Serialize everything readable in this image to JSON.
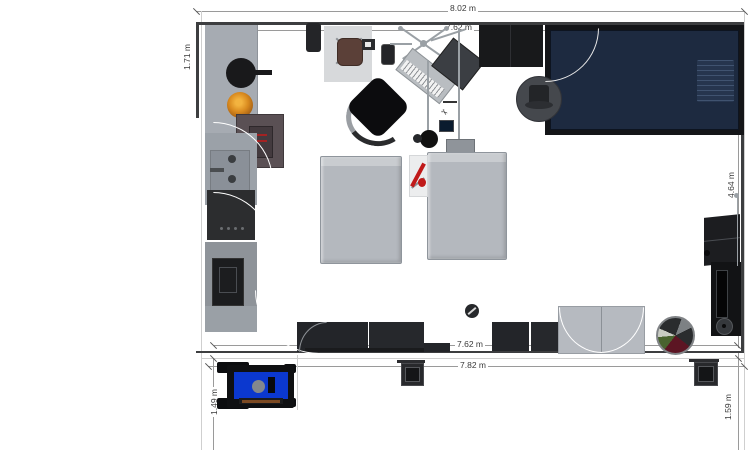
{
  "title": "floor-plan",
  "dimensions": {
    "top_outer": "8.02 m",
    "top_inner": "7.62 m",
    "bottom_inner": "7.62 m",
    "bottom_outer": "7.82 m",
    "right_side": "4.64 m",
    "left_side": "1.71 m",
    "bottom_left": "1.49 m",
    "bottom_right": "1.59 m"
  },
  "icons": {
    "scissors": "✂"
  },
  "colors": {
    "wall": "#3d3e40",
    "navy_bed": "#1d2a40",
    "foosball_blue": "#0b38cf",
    "counter_gray": "#a6abb2",
    "bed_gray": "#b8bcc2",
    "couch_dark": "#232529",
    "guitar_red": "#c01a1a",
    "food_orange": "#d98a1f",
    "rug_gray": "#d7d9db"
  },
  "furniture_names": [
    "kitchen-counter",
    "frying-pan",
    "food-plate",
    "wall-cabinet",
    "sink",
    "cooktop",
    "refrigerator",
    "desk-rug",
    "desk-chair",
    "speaker",
    "keyboard-stand",
    "keyboard",
    "amplifier",
    "office-chair",
    "mic-stand",
    "microphone",
    "bed-left",
    "bed-right",
    "guitar-stand",
    "double-bed-navy",
    "wardrobe",
    "stool-with-hat",
    "sofa-sectional",
    "sofa-right",
    "double-door-cabinet",
    "laundry-basket",
    "speaker-tower",
    "foosball-table",
    "side-table",
    "ball"
  ]
}
